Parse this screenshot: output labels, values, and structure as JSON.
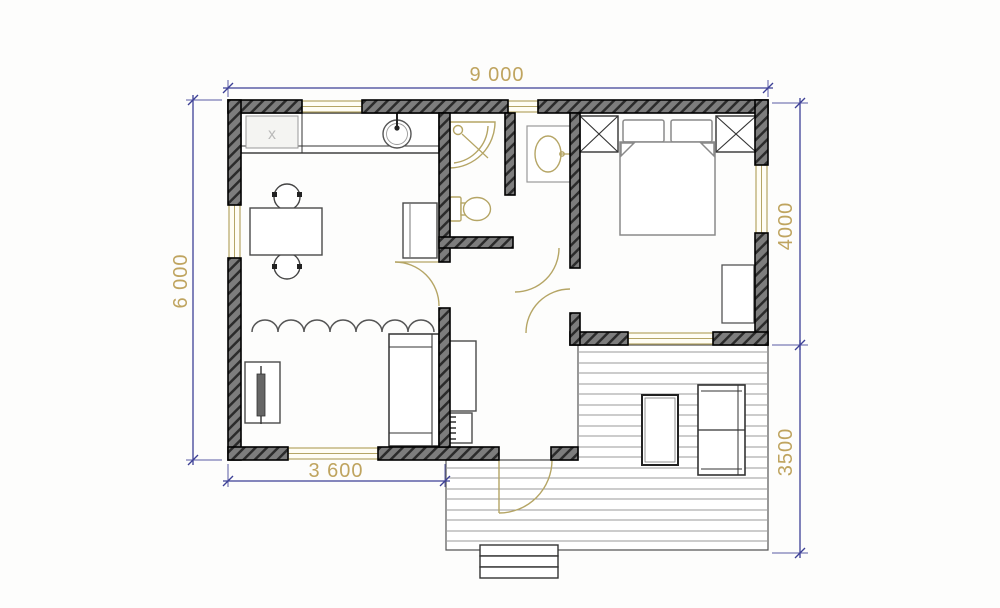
{
  "drawing": {
    "type": "floor-plan",
    "dimensions": {
      "overall_width": "9 000",
      "overall_height": "6 000",
      "bedroom_side_depth": "4000",
      "terrace_side_depth": "3500",
      "living_room_width": "3 600"
    },
    "markers": {
      "cooktop": "x"
    },
    "colors": {
      "dimension_line": "#3d4096",
      "dimension_text": "#bfa45f",
      "fixture_outline": "#b5a565",
      "wall_fill": "#7d7d7d",
      "wall_hatch": "#2b2b2b",
      "furniture_outline": "#4a4a4a",
      "deck_line": "#9a9a9a",
      "background": "#ffffff"
    },
    "icons": [
      {
        "name": "shower-icon"
      },
      {
        "name": "toilet-icon"
      },
      {
        "name": "washbasin-icon"
      },
      {
        "name": "kitchen-sink-icon"
      },
      {
        "name": "cooktop-icon"
      },
      {
        "name": "dining-table-icon"
      },
      {
        "name": "fridge-icon"
      },
      {
        "name": "curtain-divider-icon"
      },
      {
        "name": "tv-stand-icon"
      },
      {
        "name": "sofa-icon"
      },
      {
        "name": "wardrobe-icon"
      },
      {
        "name": "shoe-rack-icon"
      },
      {
        "name": "double-bed-icon"
      },
      {
        "name": "closet-x-icon"
      },
      {
        "name": "lounge-chair-icon"
      },
      {
        "name": "deck-steps-icon"
      },
      {
        "name": "door-swing-icon"
      },
      {
        "name": "window-icon"
      }
    ]
  }
}
